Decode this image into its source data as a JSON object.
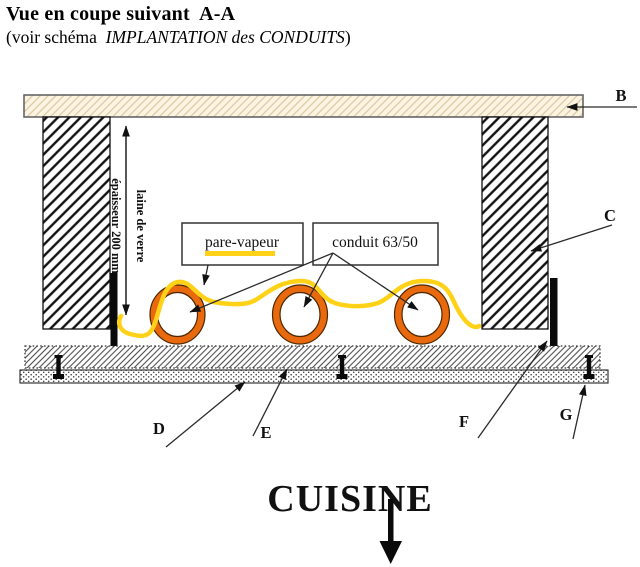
{
  "title": "Vue en coupe suivant  A-A",
  "subtitle": {
    "prefix": "(voir schéma  ",
    "italic": "IMPLANTATION des CONDUITS",
    "suffix": ")"
  },
  "insulation": {
    "line1": "laine de verre",
    "line2": "épaisseur 200 mm"
  },
  "callouts": {
    "pare_vapeur": "pare-vapeur",
    "conduit": "conduit 63/50"
  },
  "labels": {
    "b": "B",
    "c": "C",
    "d": "D",
    "e": "E",
    "f": "F",
    "g": "G"
  },
  "room": "CUISINE",
  "colors": {
    "membrane_yellow": "#FFD117",
    "conduit_orange": "#E8690E",
    "beam_fill": "#FBF4E3",
    "beam_hatch": "#D8C49A"
  }
}
